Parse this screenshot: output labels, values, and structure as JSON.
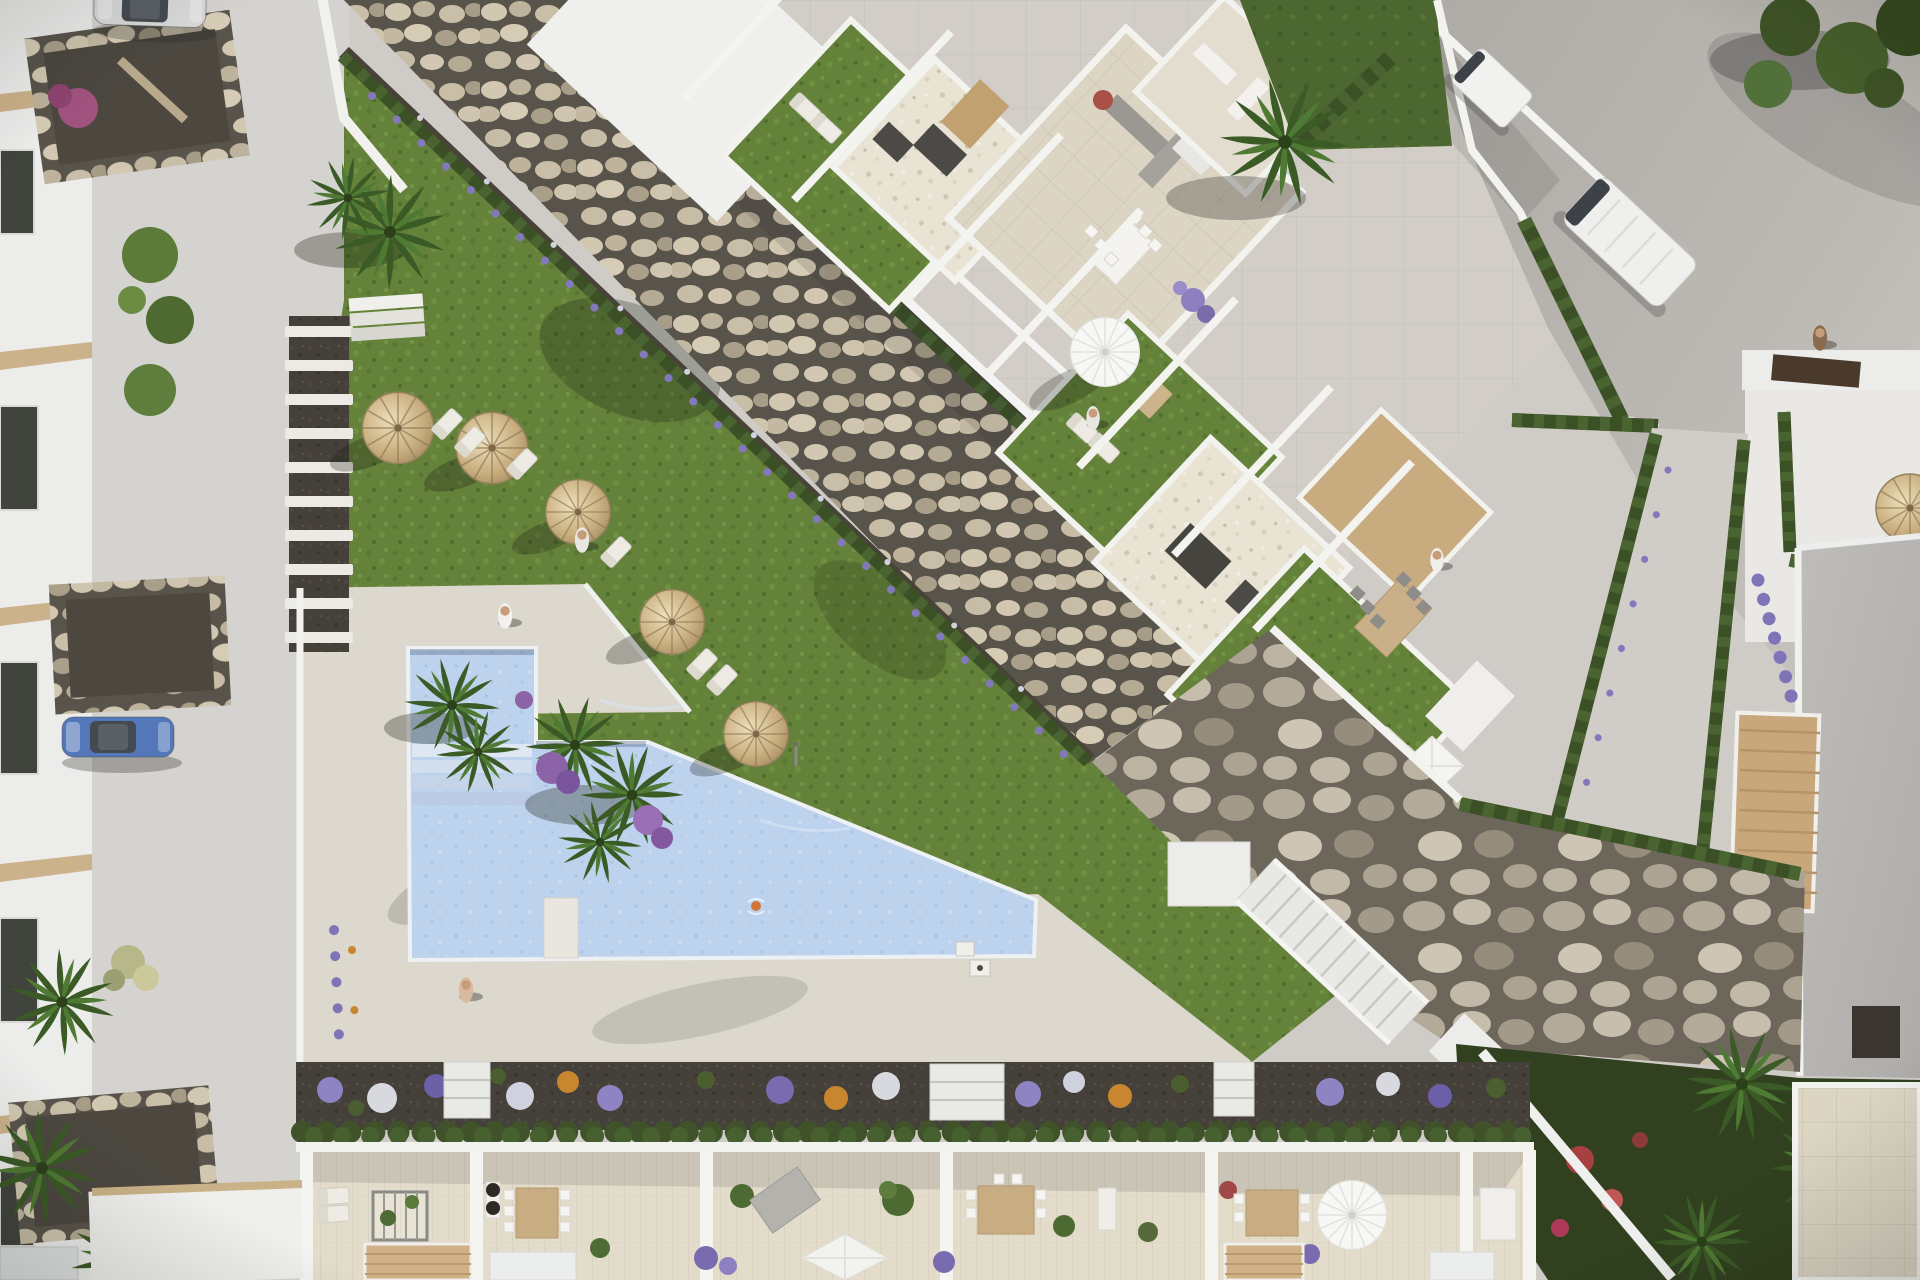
{
  "scene": {
    "title": "Aerial top-down 3D render of a Mediterranean residential complex with communal pool and gardens",
    "description": "Photorealistic architect visualization seen from directly above: a diagonal white apartment block with roof terraces and lawns, a dry-river rock strip, a communal L-shaped pool with sun deck, straw parasols and loungers, a lower row of private terraces with pergolas and dining sets, streets with parked cars and vans, palm trees, lavender borders and gabion stone walls.",
    "view": "top-down aerial",
    "lighting": "low warm sun, long shadows toward lower-left"
  },
  "palette": {
    "pavement": "#d3d0cb",
    "road": "#b5b1ac",
    "white_walls": "#f2f2ef",
    "terrace_tile": "#dcd5c4",
    "pool_water": "#bdd2ec",
    "lawn": "#64823a",
    "hedge": "#3c5026",
    "river_stones": "#c9bfa8",
    "soil": "#45413a",
    "wood": "#c9ab80",
    "lavender": "#8478bd",
    "straw": "#c4a977"
  },
  "objects": {
    "pool": {
      "shape": "L-shaped",
      "features": [
        "entry steps",
        "swim platform",
        "swimmer",
        "outdoor shower",
        "barbecue corner"
      ]
    },
    "straw_parasols": 6,
    "white_parasols": 3,
    "sun_loungers": 14,
    "people": 7,
    "cars": [
      {
        "type": "sedan",
        "color": "silver",
        "location": "top-left street"
      },
      {
        "type": "hatchback",
        "color": "blue",
        "location": "left street"
      },
      {
        "type": "panel-van",
        "color": "white",
        "location": "right road"
      },
      {
        "type": "box-van",
        "color": "white",
        "location": "top road"
      }
    ],
    "buildings": [
      "main diagonal apartment block with roof terraces",
      "left townhouse row",
      "right villas with gray roof",
      "bottom terrace row with pergolas"
    ],
    "landscape": [
      "dry river rock strip",
      "gabion stone wall",
      "white staircase",
      "stepping stone path",
      "flower beds",
      "lavender borders",
      "palm trees",
      "banana plants"
    ],
    "bottom_terraces": 6
  }
}
